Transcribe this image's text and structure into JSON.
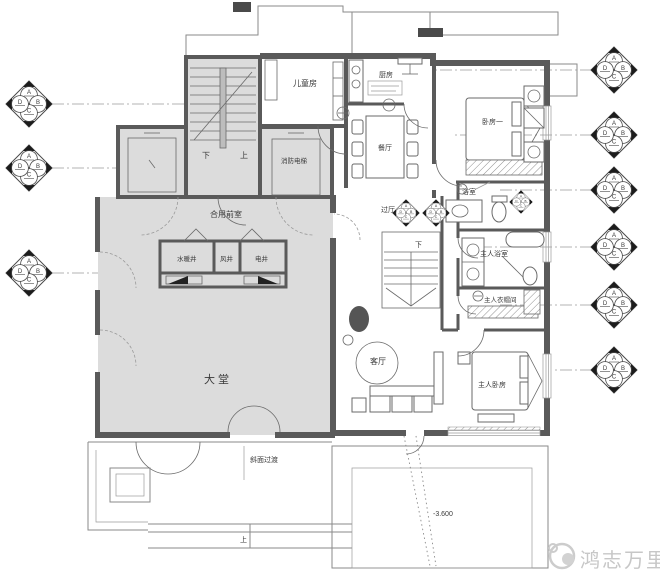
{
  "rooms": {
    "childrens_room": "儿童房",
    "kitchen": "厨房",
    "dining_room": "餐厅",
    "fire_elevator": "消防电梯",
    "shared_front_room": "合用前室",
    "plumbing_shaft": "水暖井",
    "air_shaft": "风井",
    "electrical_shaft": "电井",
    "lobby": "大堂",
    "hallway": "过厅",
    "corridor": "过道",
    "bedroom_one": "卧房一",
    "bathroom": "浴室",
    "master_bathroom": "主人浴室",
    "master_closet": "主人衣帽间",
    "master_bedroom": "主人卧房",
    "living_room": "客厅"
  },
  "stairs": {
    "public_down": "下",
    "public_up": "上",
    "unit_down": "下",
    "terrace_up": "上"
  },
  "annotations": {
    "slope_transition": "斜面过渡",
    "floor_level": "-3.600"
  },
  "elevation_marker": {
    "top": "A",
    "right": "B",
    "bottom": "C",
    "left": "D"
  },
  "watermark": {
    "brand": "鸿志万里"
  },
  "colors": {
    "wall": "#5a5a5a",
    "public_fill": "#dcdcdc",
    "thin_line": "#8a8a8a",
    "watermark": "#c7c7c7"
  }
}
